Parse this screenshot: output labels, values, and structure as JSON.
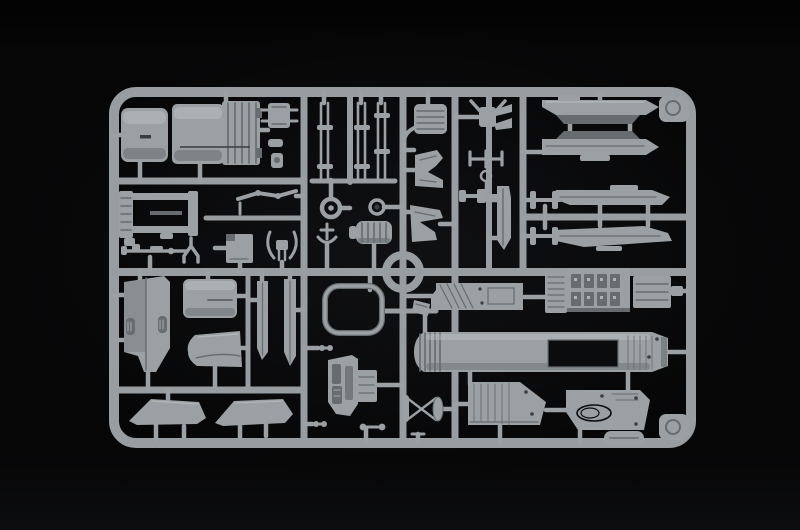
{
  "scene": {
    "description": "Top-down studio photograph of a light grey injection-moulded sprue (parts tree) from a plastic scale-model aircraft kit, lying on a black background",
    "media_type": "photograph",
    "subject": "model kit sprue with moulded aircraft parts",
    "text_content": "none visible"
  },
  "colors": {
    "background": "#060607",
    "background_glow": "#101113",
    "rail": "#979da0",
    "plastic_mid": "#9aa0a3",
    "plastic_light": "#c1c5c7",
    "plastic_dark": "#666c6f",
    "plastic_deep": "#3a3e41",
    "recess_dark": "#0b0c0d"
  },
  "sprue": {
    "frame_shape": "rounded rectangle with internal runner rails and a circular runner ring at centre",
    "corner_tabs": [
      "top-right",
      "bottom-right"
    ],
    "parts": [
      {
        "name": "exhaust-nozzle-front-half",
        "location": "top-left",
        "note": "smooth cylindrical half"
      },
      {
        "name": "exhaust-nozzle-rear-half",
        "location": "top-left",
        "note": "cylinder half with ribbed petal end"
      },
      {
        "name": "valve-fitting",
        "location": "top-left",
        "note": "small block with side pins"
      },
      {
        "name": "small-fittings-cluster",
        "location": "top-left"
      },
      {
        "name": "chassis-frame",
        "location": "mid-left",
        "note": "rectangular ladder frame"
      },
      {
        "name": "linkage-rod",
        "location": "mid-left"
      },
      {
        "name": "rifle-rod",
        "location": "mid-left"
      },
      {
        "name": "y-strut",
        "location": "mid-left"
      },
      {
        "name": "access-panel",
        "location": "mid-left"
      },
      {
        "name": "antler-bracket",
        "location": "mid-left"
      },
      {
        "name": "landing-gear-rod-set",
        "location": "top-middle",
        "note": "three pairs of long thin rods with cross ties"
      },
      {
        "name": "wheel-hub-large",
        "location": "top-middle"
      },
      {
        "name": "wheel-hub-small",
        "location": "top-middle"
      },
      {
        "name": "anchor-strut",
        "location": "top-middle"
      },
      {
        "name": "engine-accessory-block",
        "location": "top-middle",
        "note": "ribbed drum"
      },
      {
        "name": "seat-cushion",
        "location": "top-middle",
        "note": "ribbed pad"
      },
      {
        "name": "boot-bracket",
        "location": "top-middle"
      },
      {
        "name": "wedge-bracket",
        "location": "top-middle"
      },
      {
        "name": "clamp-fork",
        "location": "top-middle"
      },
      {
        "name": "tow-bar",
        "location": "top-middle"
      },
      {
        "name": "ring-pin",
        "location": "top-middle"
      },
      {
        "name": "cross-fitting",
        "location": "top-middle"
      },
      {
        "name": "blade-pylon",
        "location": "top-middle"
      },
      {
        "name": "h-brace-upper",
        "location": "top-right"
      },
      {
        "name": "h-brace-lower",
        "location": "top-right"
      },
      {
        "name": "store-rail-upper-a",
        "location": "top-right",
        "note": "long flat rail, angled ends"
      },
      {
        "name": "store-rail-upper-b",
        "location": "top-right"
      },
      {
        "name": "store-rail-lower-a",
        "location": "top-right"
      },
      {
        "name": "store-rail-lower-b",
        "location": "top-right"
      },
      {
        "name": "wing-panel-slab",
        "location": "bottom-left",
        "note": "flat slab with two slot recesses"
      },
      {
        "name": "intake-duct",
        "location": "bottom-left",
        "note": "horizontal cylinder"
      },
      {
        "name": "nose-cone",
        "location": "bottom-left",
        "note": "tapered cone pointing left"
      },
      {
        "name": "fin-half-a",
        "location": "bottom-left"
      },
      {
        "name": "fin-half-b",
        "location": "bottom-left"
      },
      {
        "name": "taileron-a",
        "location": "bottom-left",
        "note": "trapezoidal fin"
      },
      {
        "name": "taileron-b",
        "location": "bottom-left",
        "note": "trapezoidal fin"
      },
      {
        "name": "canopy-frame-ring",
        "location": "bottom-middle",
        "note": "thin rounded-square hoop"
      },
      {
        "name": "mirror-wedge",
        "location": "bottom-middle"
      },
      {
        "name": "cockpit-tub",
        "location": "bottom-middle",
        "note": "tub with console recesses"
      },
      {
        "name": "side-console-box",
        "location": "bottom-middle"
      },
      {
        "name": "x-brace-strut",
        "location": "bottom-middle",
        "note": "crossed struts with oval pad"
      },
      {
        "name": "dumbbell-pins",
        "location": "bottom-middle"
      },
      {
        "name": "avionics-panel",
        "location": "bottom-right",
        "note": "flat panel with diagonal ribs"
      },
      {
        "name": "equipment-bay-box",
        "location": "bottom-right",
        "note": "box with rows of connector blocks"
      },
      {
        "name": "ribbed-electronics-box",
        "location": "bottom-right"
      },
      {
        "name": "rear-fuselage-half",
        "location": "bottom-right",
        "note": "long body with dark rectangular wing slot"
      },
      {
        "name": "wing-glove-panel-a",
        "location": "bottom-right"
      },
      {
        "name": "wing-glove-panel-b",
        "location": "bottom-right",
        "note": "panel with oval recess"
      },
      {
        "name": "corner-gusset-top-right",
        "location": "frame"
      },
      {
        "name": "corner-gusset-bottom-right",
        "location": "frame"
      },
      {
        "name": "moulding-tab",
        "location": "frame bottom rail"
      }
    ]
  }
}
